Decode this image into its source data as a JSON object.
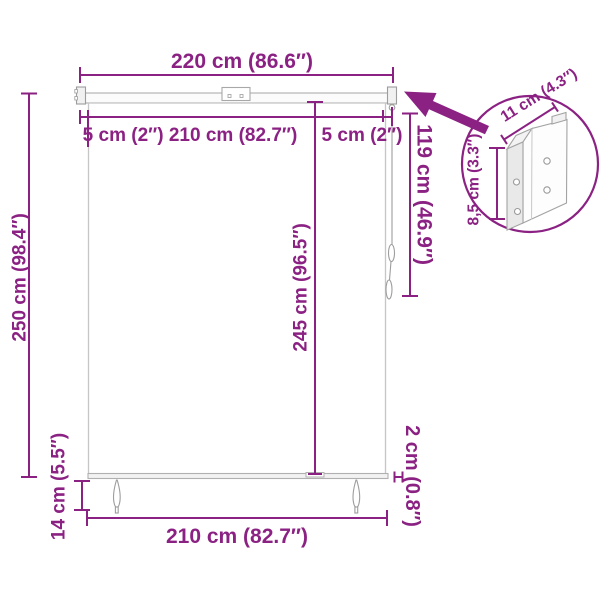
{
  "colors": {
    "dimension_accent": "#8B2283",
    "product_outline": "#bdbdbd"
  },
  "dimensions": {
    "top_width": "220 cm (86.6″)",
    "rail_segments": "5 cm (2″) 210 cm (82.7″)",
    "rail_segment_right": "5 cm (2″)",
    "total_height": "250 cm (98.4″)",
    "fabric_height": "245 cm (96.5″)",
    "cord_height": "119 cm (46.9″)",
    "ground_clearance": "14 cm (5.5″)",
    "bottom_width": "210 cm (82.7″)",
    "bar_end_width": "2 cm (0.8″)",
    "bracket_height": "8,5 cm (3.3″)",
    "bracket_width": "11 cm (4.3″)"
  }
}
